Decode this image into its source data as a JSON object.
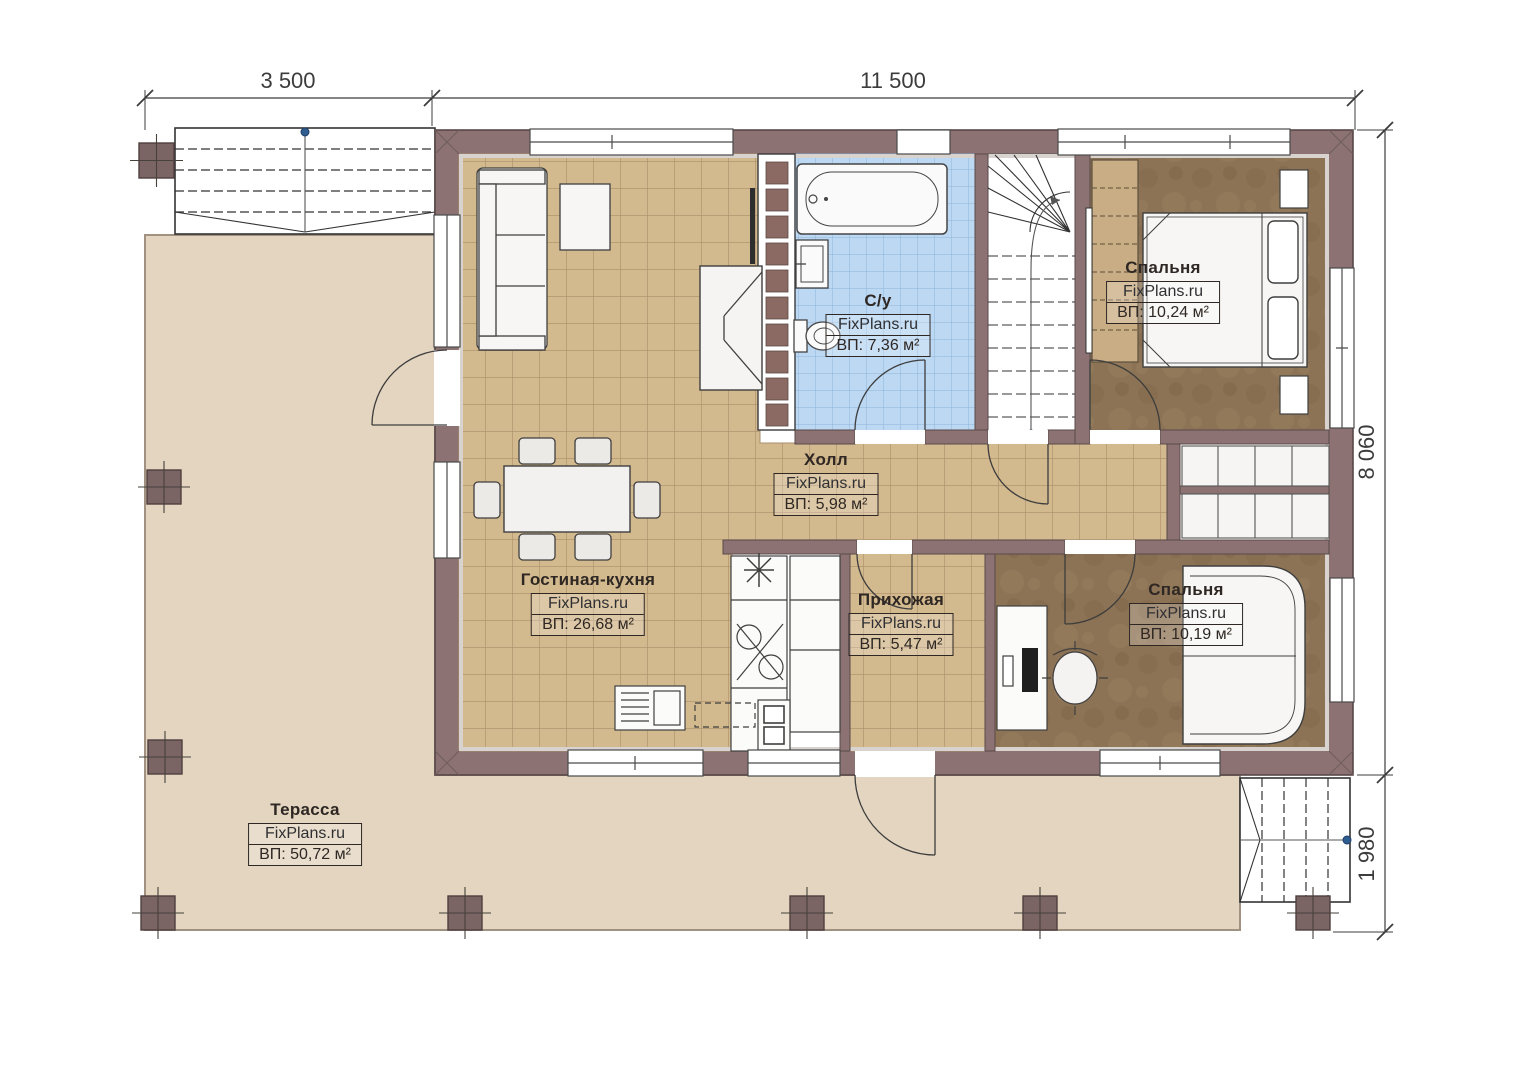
{
  "watermark": "FixPlans.ru",
  "dimensions": {
    "top_left": "3 500",
    "top_span": "11 500",
    "right_house": "8 060",
    "right_porch": "1 980"
  },
  "rooms": {
    "bathroom": {
      "name": "С/у",
      "brand": "FixPlans.ru",
      "area": "ВП: 7,36 м²"
    },
    "bedroom1": {
      "name": "Спальня",
      "brand": "FixPlans.ru",
      "area": "ВП: 10,24 м²"
    },
    "hall": {
      "name": "Холл",
      "brand": "FixPlans.ru",
      "area": "ВП: 5,98 м²"
    },
    "living": {
      "name": "Гостиная-кухня",
      "brand": "FixPlans.ru",
      "area": "ВП: 26,68 м²"
    },
    "entry": {
      "name": "Прихожая",
      "brand": "FixPlans.ru",
      "area": "ВП: 5,47 м²"
    },
    "bedroom2": {
      "name": "Спальня",
      "brand": "FixPlans.ru",
      "area": "ВП: 10,19 м²"
    },
    "terrace": {
      "name": "Терасса",
      "brand": "FixPlans.ru",
      "area": "ВП: 50,72 м²"
    }
  },
  "colors": {
    "wall": "#8c7272",
    "terrace_floor": "#e3d5bf",
    "tile_tan": "#d3b98e",
    "tile_tan_line": "#ab8e6b",
    "tile_blue": "#bcd8f3",
    "tile_blue_line": "#8fb4da",
    "floor_brown": "#8d7355",
    "closet_tan": "#c9ae85",
    "dimension": "#3c3c3c",
    "walkline_dot": "#2f5d8f"
  }
}
